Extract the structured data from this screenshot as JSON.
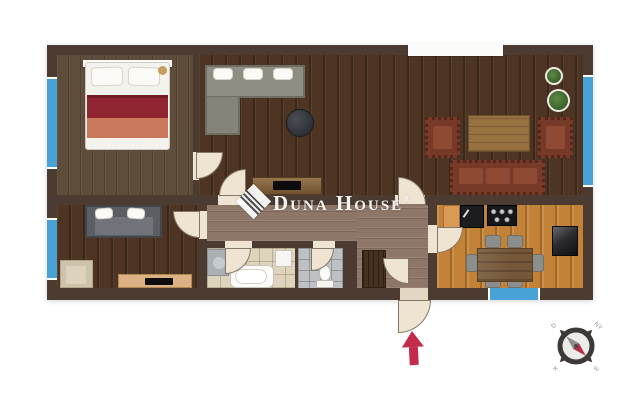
{
  "watermark": {
    "brand": "Duna House",
    "registered": "®"
  },
  "compass": {
    "labels": {
      "nw": "D",
      "ne": "NY",
      "se": "É",
      "sw": "K"
    }
  },
  "colors": {
    "canvas": "#ffffff",
    "wall": "#4b3b31",
    "window": "#48a2d6",
    "door": "#efe4d2",
    "arrow": "#c5294b",
    "bedroom_floor": "#5f4d3c",
    "living_floor": "#4e3523",
    "hall_floor": "#8e7769",
    "bathroom_floor": "#ded4bd",
    "wc_floor": "#bdc1c3",
    "kitchen_floor": "#c28238"
  },
  "legend": {
    "rooms": [
      "bedroom",
      "living-room",
      "lounge",
      "hallway",
      "bathroom",
      "wc",
      "kitchen-dining"
    ],
    "fixtures": [
      "double-bed",
      "corner-sofa",
      "ottoman",
      "tv-stand",
      "leather-armchair",
      "coffee-table",
      "leather-sofa",
      "potted-plant",
      "small-sofa",
      "beige-armchair",
      "washing-machine",
      "bathtub",
      "wash-basin",
      "toilet",
      "wardrobe",
      "kitchen-cabinet",
      "kitchen-sink",
      "cooktop",
      "fridge",
      "dining-table",
      "dining-chair",
      "entrance-door",
      "compass-rose",
      "entrance-arrow"
    ]
  }
}
